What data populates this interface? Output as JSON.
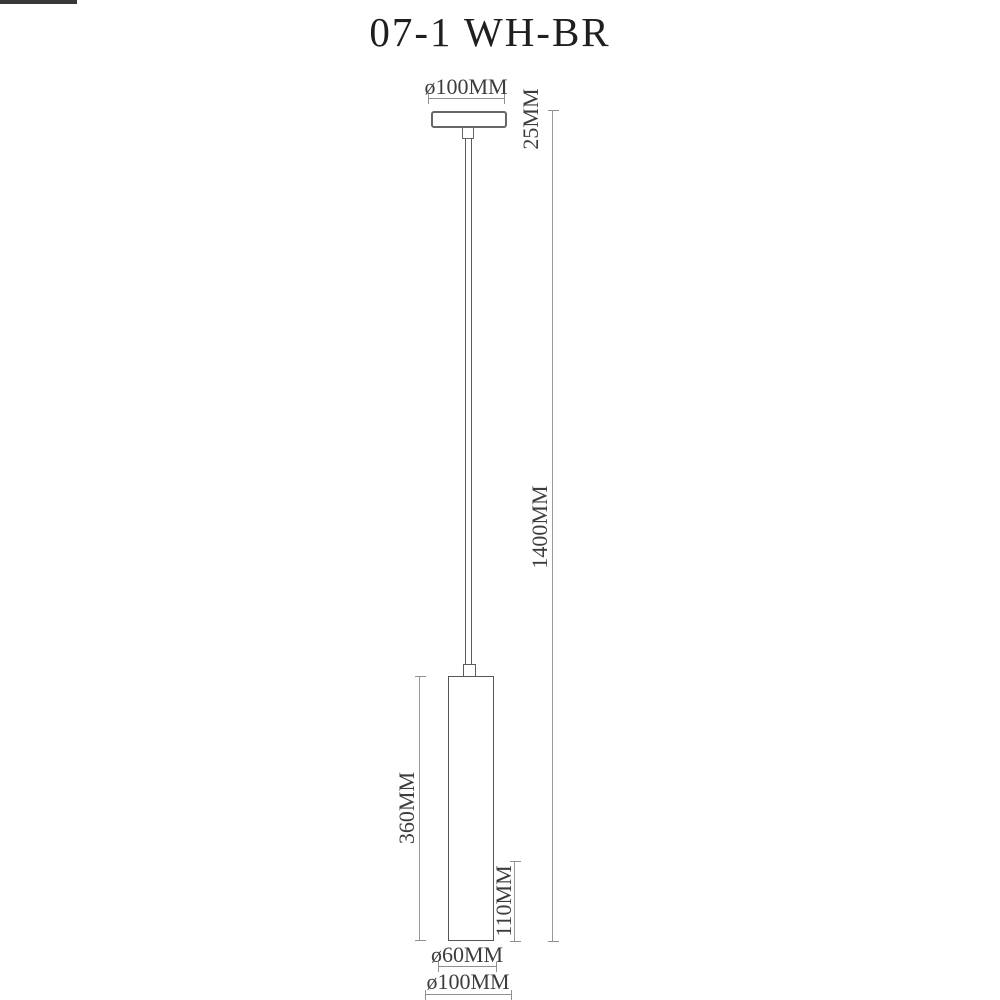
{
  "title": "07-1 WH-BR",
  "drawing_type": "pendant-lamp-dimension-drawing",
  "dimensions": {
    "canopy_diameter": "ø100MM",
    "canopy_height": "25MM",
    "suspension_length": "1400MM",
    "body_length": "360MM",
    "lower_section_height": "110MM",
    "shade_diameter": "ø60MM",
    "base_diameter": "ø100MM"
  },
  "colors": {
    "background": "#ffffff",
    "outline": "#5c5c5c",
    "dimension_line": "#8f8f8f",
    "text": "#3d3d3d",
    "band": "#383838",
    "title_text": "#1f1f1f"
  }
}
